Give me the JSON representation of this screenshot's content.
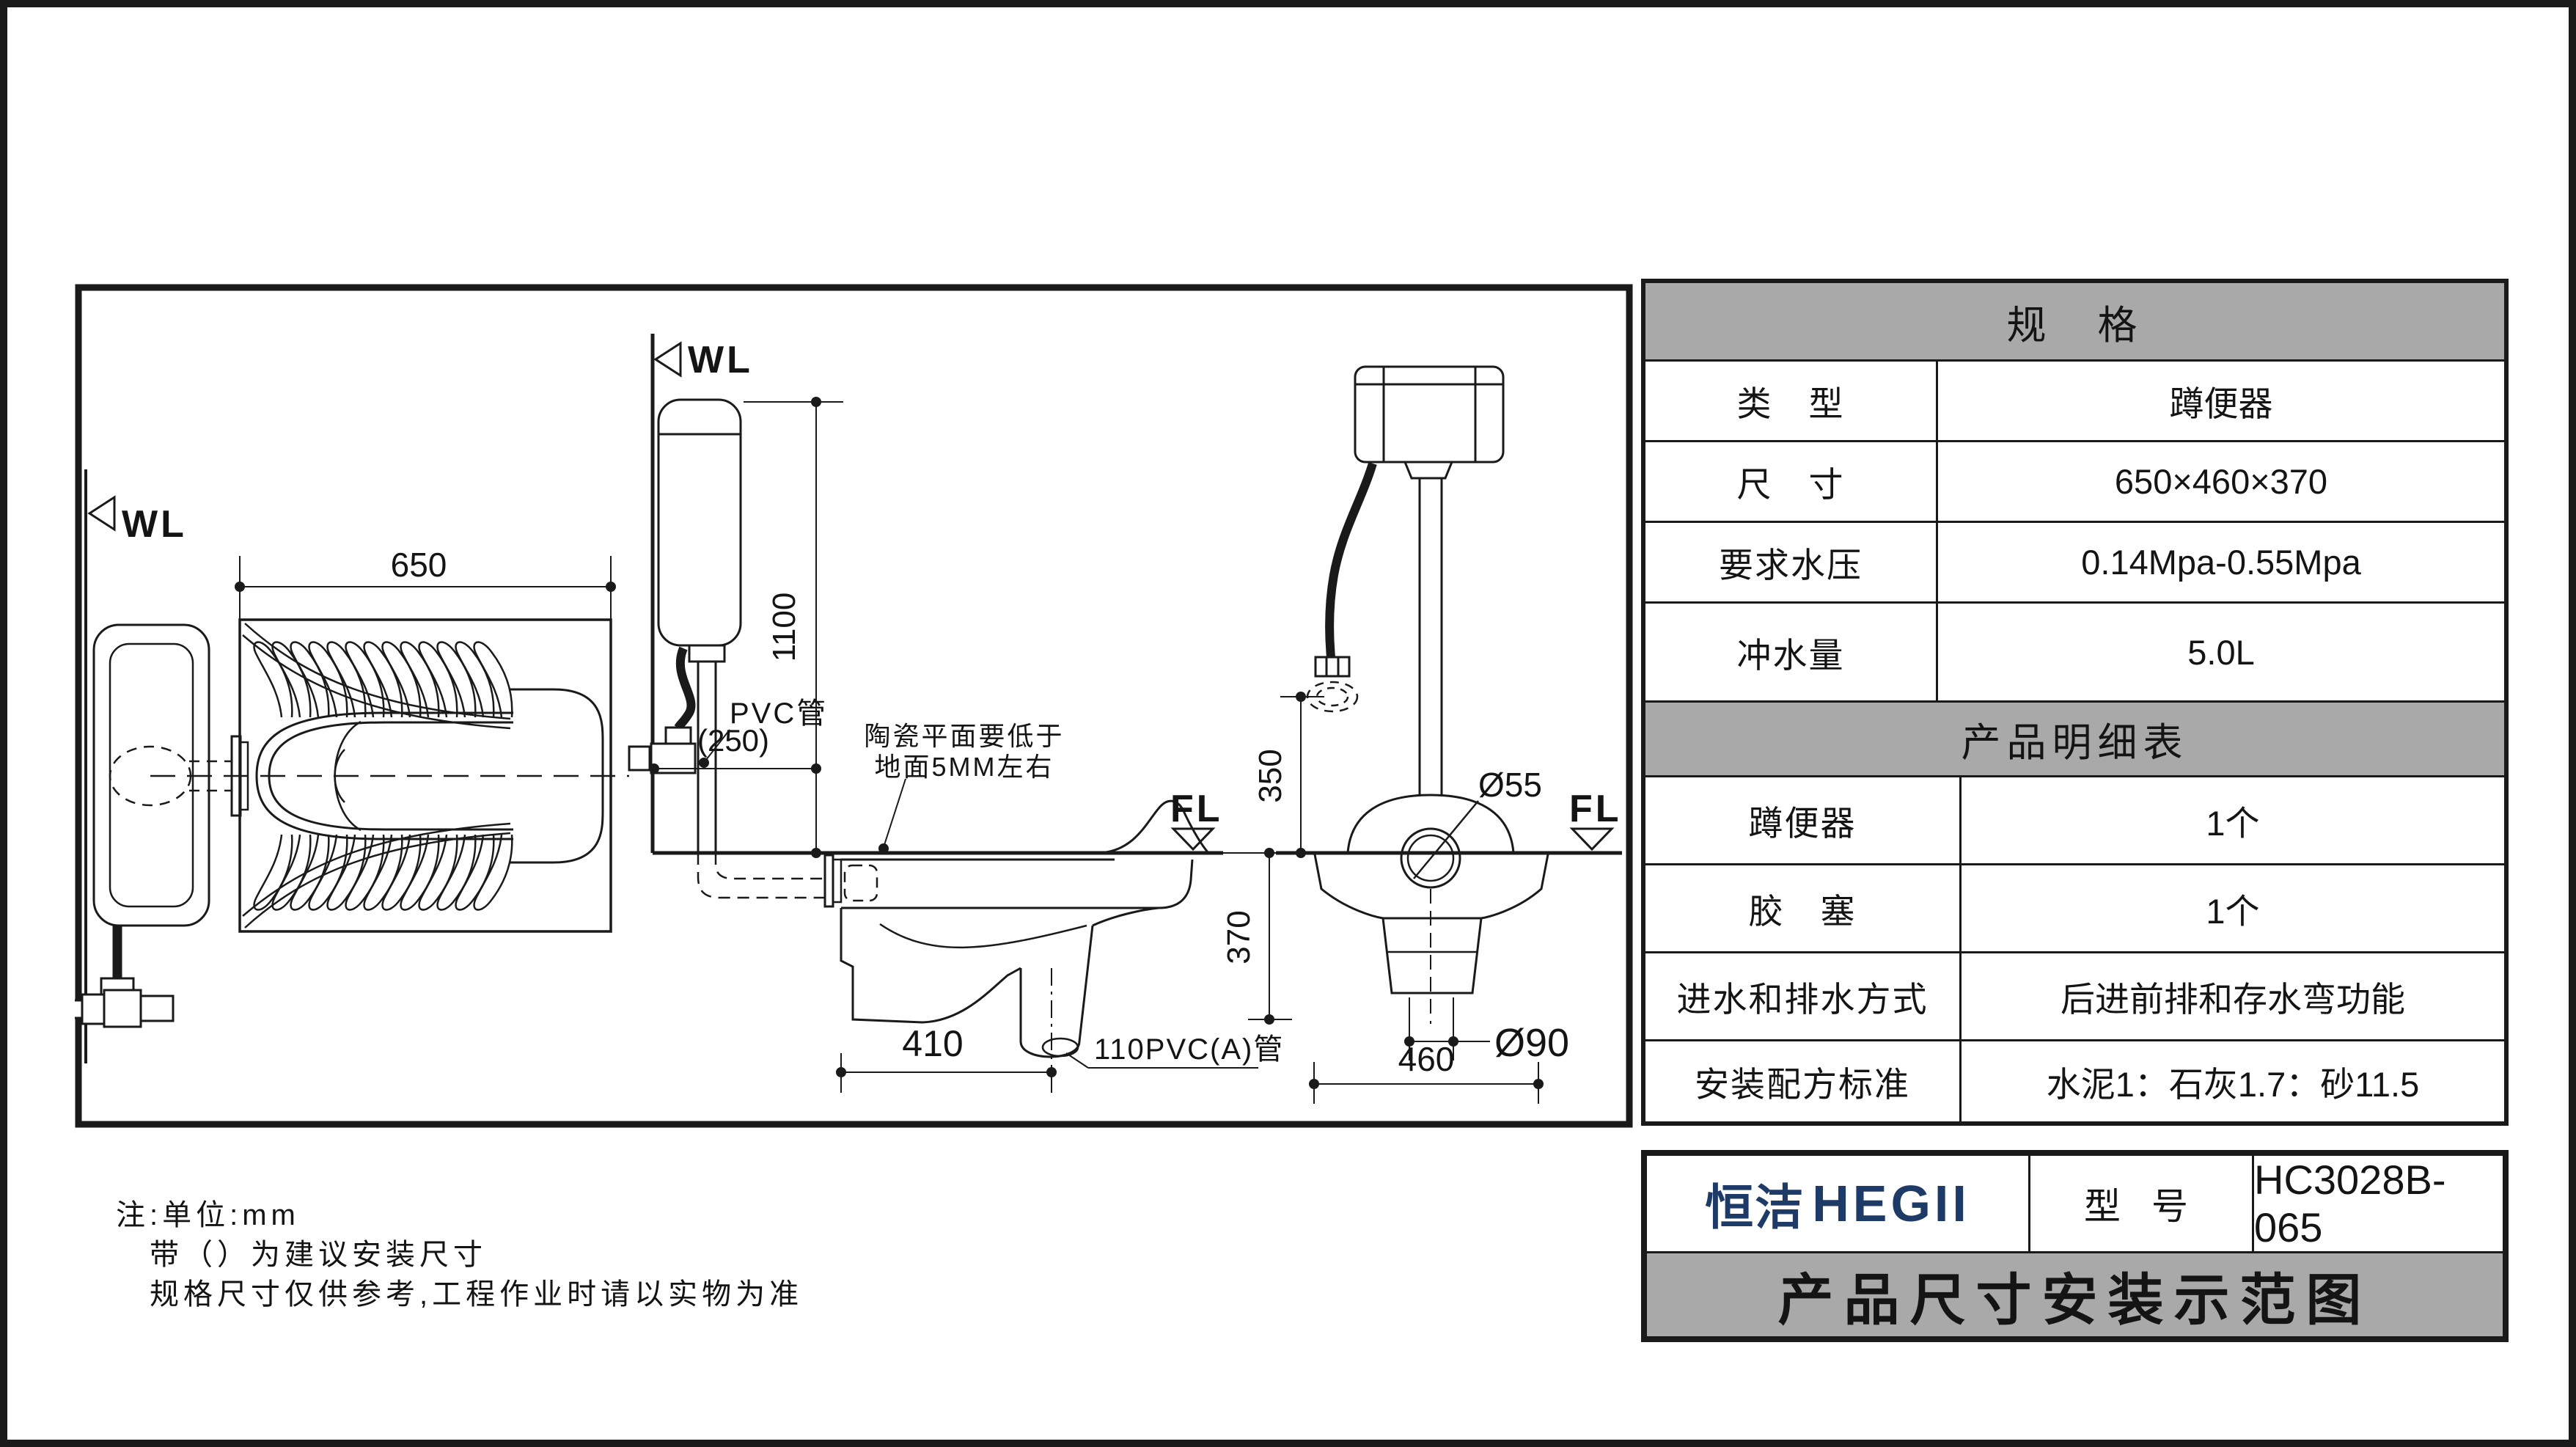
{
  "colors": {
    "line": "#1a1a1a",
    "header_gray": "#a9a9a9",
    "brand_navy": "#1e3a66"
  },
  "spec_table": {
    "title": "规　格",
    "rows": [
      {
        "label": "类　型",
        "value": "蹲便器"
      },
      {
        "label": "尺　寸",
        "value": "650×460×370"
      },
      {
        "label": "要求水压",
        "value": "0.14Mpa-0.55Mpa"
      },
      {
        "label": "冲水量",
        "value": "5.0L"
      }
    ]
  },
  "parts_table": {
    "title": "产品明细表",
    "rows": [
      {
        "label": "蹲便器",
        "value": "1个"
      },
      {
        "label": "胶　塞",
        "value": "1个"
      },
      {
        "label": "进水和排水方式",
        "value": "后进前排和存水弯功能"
      },
      {
        "label": "安装配方标准",
        "value": "水泥1：石灰1.7：砂11.5"
      }
    ]
  },
  "title_block": {
    "brand_cn": "恒洁",
    "brand_en": "HEGII",
    "model_label": "型 号",
    "model": "HC3028B-065",
    "drawing_title": "产品尺寸安装示范图"
  },
  "notes": [
    "注:单位:mm",
    "带（）为建议安装尺寸",
    "规格尺寸仅供参考,工程作业时请以实物为准"
  ],
  "drawing": {
    "wl_label": "WL",
    "fl_label": "FL",
    "dims": {
      "d650": "650",
      "d1100": "1100",
      "d250": "(250)",
      "d350": "350",
      "d370": "370",
      "d410": "410",
      "d460": "460",
      "d55": "Ø55",
      "d90": "Ø90"
    },
    "labels": {
      "pvc_pipe": "PVC管",
      "pvc110_pipe": "110PVC(A)管",
      "ceramic_note_1": "陶瓷平面要低于",
      "ceramic_note_2": "地面5MM左右"
    }
  }
}
